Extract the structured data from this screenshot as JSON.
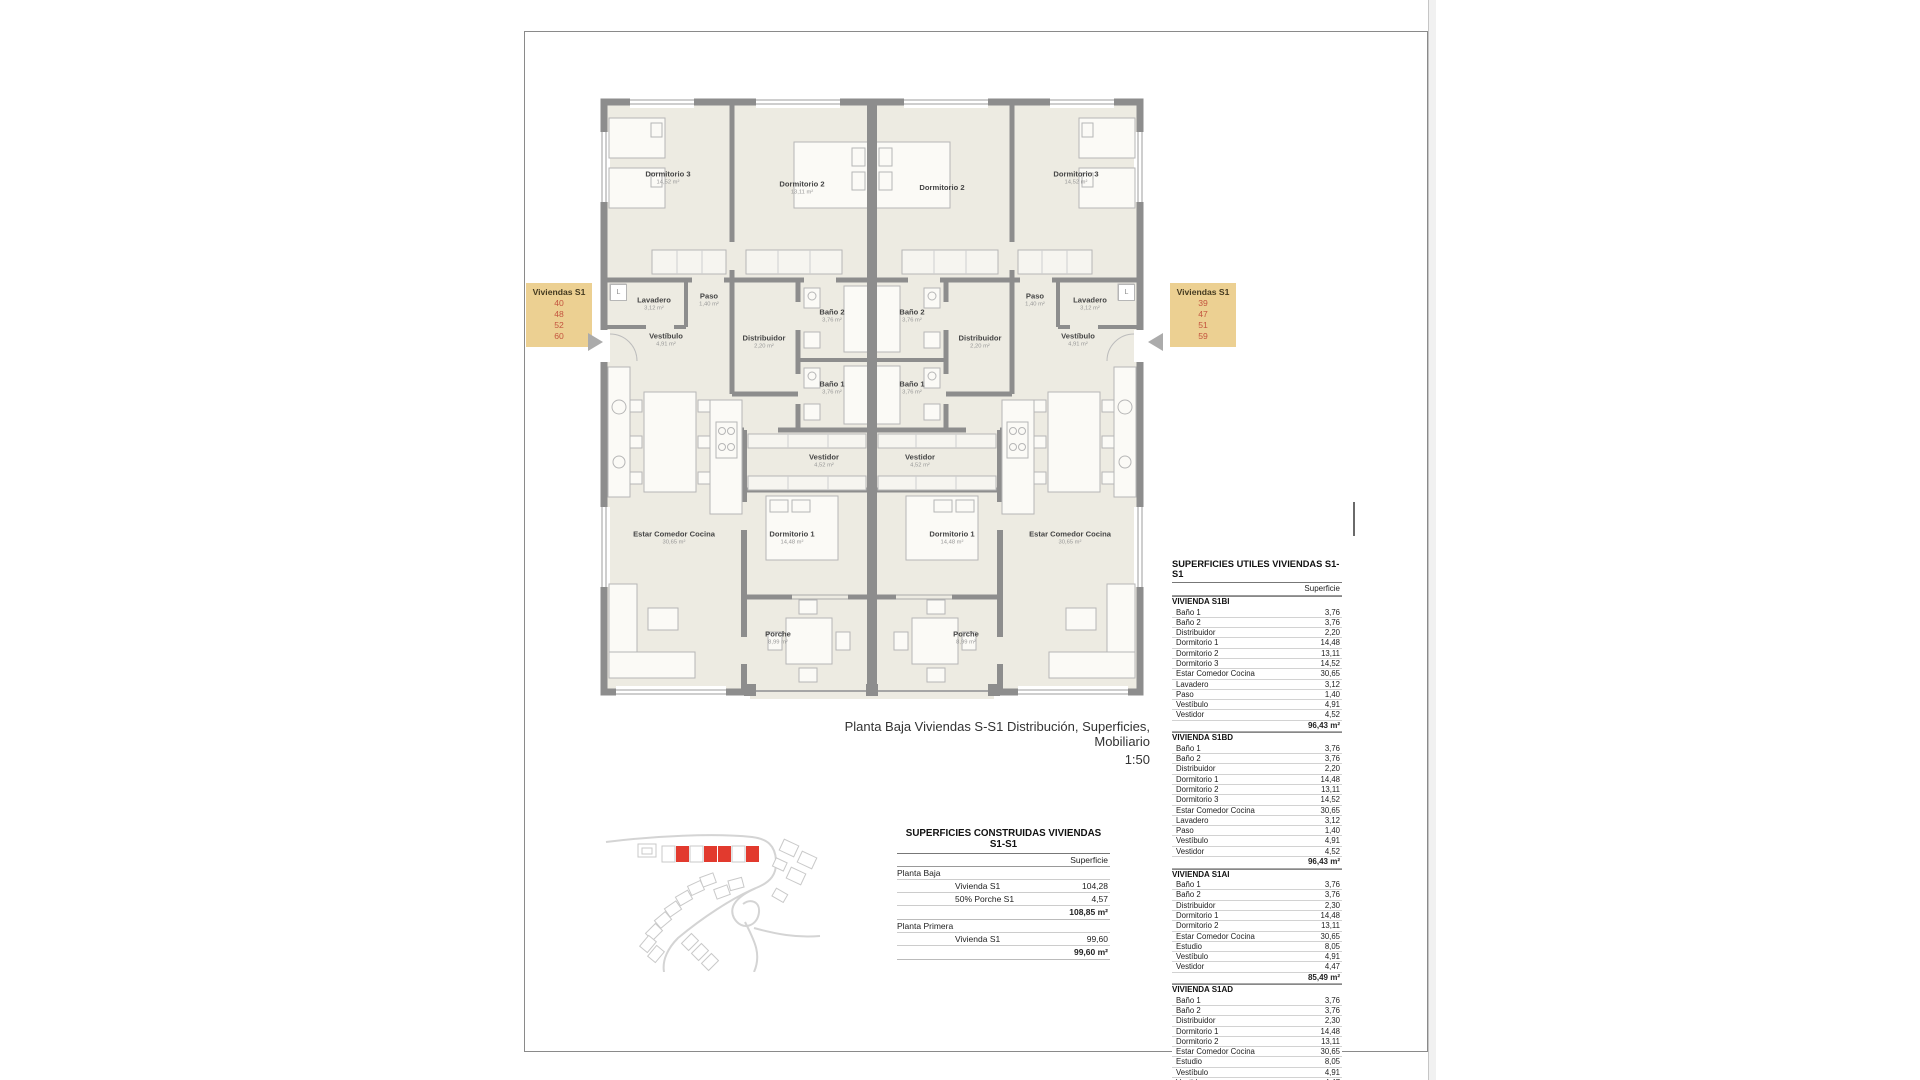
{
  "sheet": {
    "caption_line1": "Planta Baja Viviendas S-S1 Distribución, Superficies, Mobiliario",
    "caption_line2": "1:50"
  },
  "tags": {
    "left": {
      "title": "Viviendas S1",
      "units": [
        "40",
        "48",
        "52",
        "60"
      ]
    },
    "right": {
      "title": "Viviendas S1",
      "units": [
        "39",
        "47",
        "51",
        "59"
      ]
    },
    "bg_color": "#ecd092",
    "number_color": "#c4553f"
  },
  "plan": {
    "laundry_symbol": "L",
    "rooms": {
      "dormitorio1": {
        "name": "Dormitorio 1",
        "area": "14,48 m²"
      },
      "dormitorio2": {
        "name": "Dormitorio 2",
        "area": "13,11 m²"
      },
      "dormitorio3": {
        "name": "Dormitorio 3",
        "area": "14,52 m²"
      },
      "bano1": {
        "name": "Baño 1",
        "area": "3,76 m²"
      },
      "bano2": {
        "name": "Baño 2",
        "area": "3,76 m²"
      },
      "distribuidor": {
        "name": "Distribuidor",
        "area": "2,20 m²"
      },
      "estar": {
        "name": "Estar Comedor Cocina",
        "area": "30,65 m²"
      },
      "lavadero": {
        "name": "Lavadero",
        "area": "3,12 m²"
      },
      "paso": {
        "name": "Paso",
        "area": "1,40 m²"
      },
      "vestibulo": {
        "name": "Vestíbulo",
        "area": "4,91 m²"
      },
      "vestidor": {
        "name": "Vestidor",
        "area": "4,52 m²"
      },
      "porche": {
        "name": "Porche",
        "area": "8,99 m²"
      }
    }
  },
  "construidas": {
    "title": "SUPERFICIES CONSTRUIDAS VIVIENDAS S1-S1",
    "col_header": "Superficie",
    "sections": [
      {
        "label": "Planta Baja",
        "rows": [
          {
            "label": "Vivienda S1",
            "value": "104,28"
          },
          {
            "label": "50% Porche S1",
            "value": "4,57"
          }
        ],
        "subtotal": "108,85 m²"
      },
      {
        "label": "Planta Primera",
        "rows": [
          {
            "label": "Vivienda S1",
            "value": "99,60"
          }
        ],
        "subtotal": "99,60 m²"
      }
    ]
  },
  "utiles": {
    "title": "SUPERFICIES UTILES VIVIENDAS S1-S1",
    "col_header": "Superficie",
    "groups": [
      {
        "name": "VIVIENDA S1BI",
        "rows": [
          {
            "label": "Baño 1",
            "value": "3,76"
          },
          {
            "label": "Baño 2",
            "value": "3,76"
          },
          {
            "label": "Distribuidor",
            "value": "2,20"
          },
          {
            "label": "Dormitorio 1",
            "value": "14,48"
          },
          {
            "label": "Dormitorio 2",
            "value": "13,11"
          },
          {
            "label": "Dormitorio 3",
            "value": "14,52"
          },
          {
            "label": "Estar Comedor Cocina",
            "value": "30,65"
          },
          {
            "label": "Lavadero",
            "value": "3,12"
          },
          {
            "label": "Paso",
            "value": "1,40"
          },
          {
            "label": "Vestíbulo",
            "value": "4,91"
          },
          {
            "label": "Vestidor",
            "value": "4,52"
          }
        ],
        "subtotal": "96,43 m²"
      },
      {
        "name": "VIVIENDA S1BD",
        "rows": [
          {
            "label": "Baño 1",
            "value": "3,76"
          },
          {
            "label": "Baño 2",
            "value": "3,76"
          },
          {
            "label": "Distribuidor",
            "value": "2,20"
          },
          {
            "label": "Dormitorio 1",
            "value": "14,48"
          },
          {
            "label": "Dormitorio 2",
            "value": "13,11"
          },
          {
            "label": "Dormitorio 3",
            "value": "14,52"
          },
          {
            "label": "Estar Comedor Cocina",
            "value": "30,65"
          },
          {
            "label": "Lavadero",
            "value": "3,12"
          },
          {
            "label": "Paso",
            "value": "1,40"
          },
          {
            "label": "Vestíbulo",
            "value": "4,91"
          },
          {
            "label": "Vestidor",
            "value": "4,52"
          }
        ],
        "subtotal": "96,43 m²"
      },
      {
        "name": "VIVIENDA S1AI",
        "rows": [
          {
            "label": "Baño 1",
            "value": "3,76"
          },
          {
            "label": "Baño 2",
            "value": "3,76"
          },
          {
            "label": "Distribuidor",
            "value": "2,30"
          },
          {
            "label": "Dormitorio 1",
            "value": "14,48"
          },
          {
            "label": "Dormitorio 2",
            "value": "13,11"
          },
          {
            "label": "Estar Comedor Cocina",
            "value": "30,65"
          },
          {
            "label": "Estudio",
            "value": "8,05"
          },
          {
            "label": "Vestíbulo",
            "value": "4,91"
          },
          {
            "label": "Vestidor",
            "value": "4,47"
          }
        ],
        "subtotal": "85,49 m²"
      },
      {
        "name": "VIVIENDA S1AD",
        "rows": [
          {
            "label": "Baño 1",
            "value": "3,76"
          },
          {
            "label": "Baño 2",
            "value": "3,76"
          },
          {
            "label": "Distribuidor",
            "value": "2,30"
          },
          {
            "label": "Dormitorio 1",
            "value": "14,48"
          },
          {
            "label": "Dormitorio 2",
            "value": "13,11"
          },
          {
            "label": "Estar Comedor Cocina",
            "value": "30,65"
          },
          {
            "label": "Estudio",
            "value": "8,05"
          },
          {
            "label": "Vestíbulo",
            "value": "4,91"
          },
          {
            "label": "Vestidor",
            "value": "4,47"
          }
        ],
        "subtotal": "85,49 m²"
      }
    ],
    "grand_total": "363,84 m²"
  }
}
